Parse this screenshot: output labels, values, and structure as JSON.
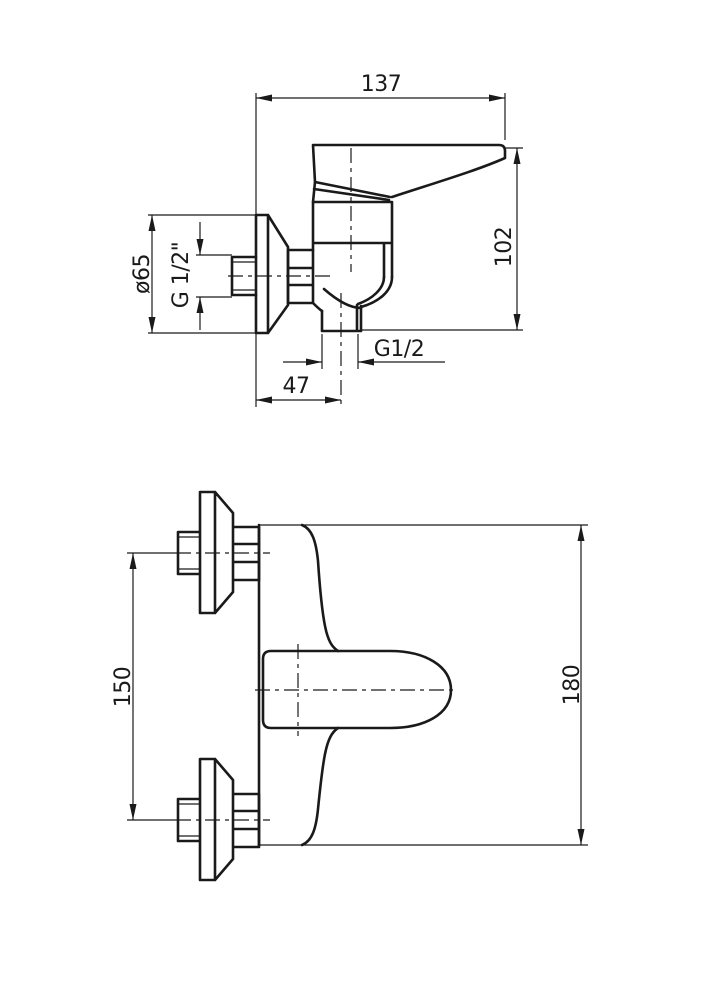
{
  "page": {
    "background": "#ffffff",
    "line_color": "#1a1a1a"
  },
  "side_view": {
    "dim_width": "137",
    "dim_height": "102",
    "dim_flange_diameter": "ø65",
    "dim_wall_thread": "G 1/2\"",
    "dim_outlet_thread": "G1/2",
    "dim_outlet_offset": "47"
  },
  "plan_view": {
    "dim_connection_spacing": "150",
    "dim_overall_width": "180"
  }
}
